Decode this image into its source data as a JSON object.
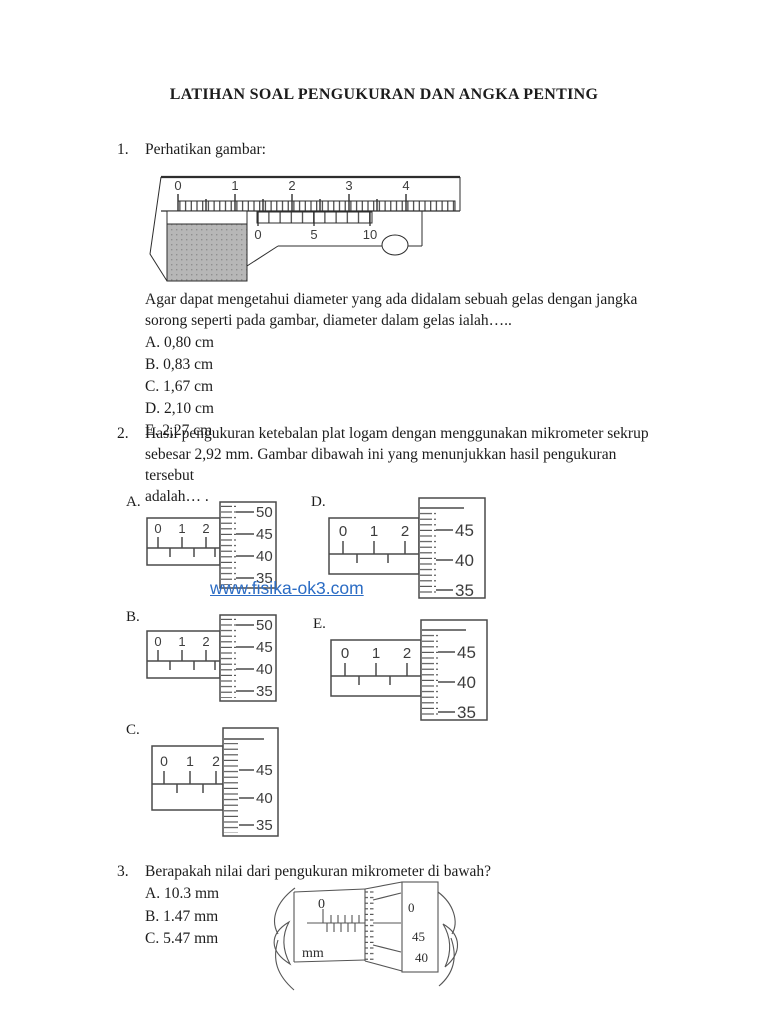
{
  "title": "LATIHAN SOAL PENGUKURAN DAN ANGKA PENTING",
  "watermark": {
    "text": "www.fisika-ok3.com",
    "color": "#2b6cc4"
  },
  "q1": {
    "number": "1.",
    "prompt": "Perhatikan gambar:",
    "caliper": {
      "main_scale": [
        "0",
        "1",
        "2",
        "3",
        "4"
      ],
      "vernier_scale": [
        "0",
        "5",
        "10"
      ]
    },
    "lines": [
      "Agar dapat mengetahui diameter yang ada didalam sebuah gelas dengan jangka",
      "sorong seperti pada gambar, diameter dalam gelas ialah….."
    ],
    "options": [
      "A. 0,80 cm",
      "B. 0,83 cm",
      "C. 1,67 cm",
      "D. 2,10 cm",
      "E. 2,27 cm"
    ]
  },
  "q2": {
    "number": "2.",
    "lines": [
      "Hasil pengukuran ketebalan plat logam dengan menggunakan mikrometer sekrup",
      "sebesar 2,92 mm. Gambar dibawah ini yang menunjukkan hasil pengukuran",
      "tersebut",
      "adalah… ."
    ],
    "diagrams": {
      "A": {
        "label": "A.",
        "main": [
          "0",
          "1",
          "2"
        ],
        "thimble": [
          "50",
          "45",
          "40",
          "35"
        ]
      },
      "B": {
        "label": "B.",
        "main": [
          "0",
          "1",
          "2"
        ],
        "thimble": [
          "50",
          "45",
          "40",
          "35"
        ]
      },
      "C": {
        "label": "C.",
        "main": [
          "0",
          "1",
          "2"
        ],
        "thimble": [
          "45",
          "40",
          "35"
        ]
      },
      "D": {
        "label": "D.",
        "main": [
          "0",
          "1",
          "2"
        ],
        "thimble": [
          "45",
          "40",
          "35"
        ]
      },
      "E": {
        "label": "E.",
        "main": [
          "0",
          "1",
          "2"
        ],
        "thimble": [
          "45",
          "40",
          "35"
        ]
      }
    }
  },
  "q3": {
    "number": "3.",
    "prompt": "Berapakah nilai dari pengukuran mikrometer di bawah?",
    "options": [
      "A. 10.3 mm",
      "B. 1.47 mm",
      "C. 5.47 mm"
    ],
    "micrometer": {
      "sleeve_zero": "0",
      "unit": "mm",
      "barrel": [
        "0",
        "45",
        "40"
      ]
    }
  },
  "colors": {
    "body_text": "#1c1c1c",
    "figure_stroke": "#4a4a4a",
    "object_fill": "#b7b7b7",
    "watermark_blue": "#2b6cc4"
  }
}
